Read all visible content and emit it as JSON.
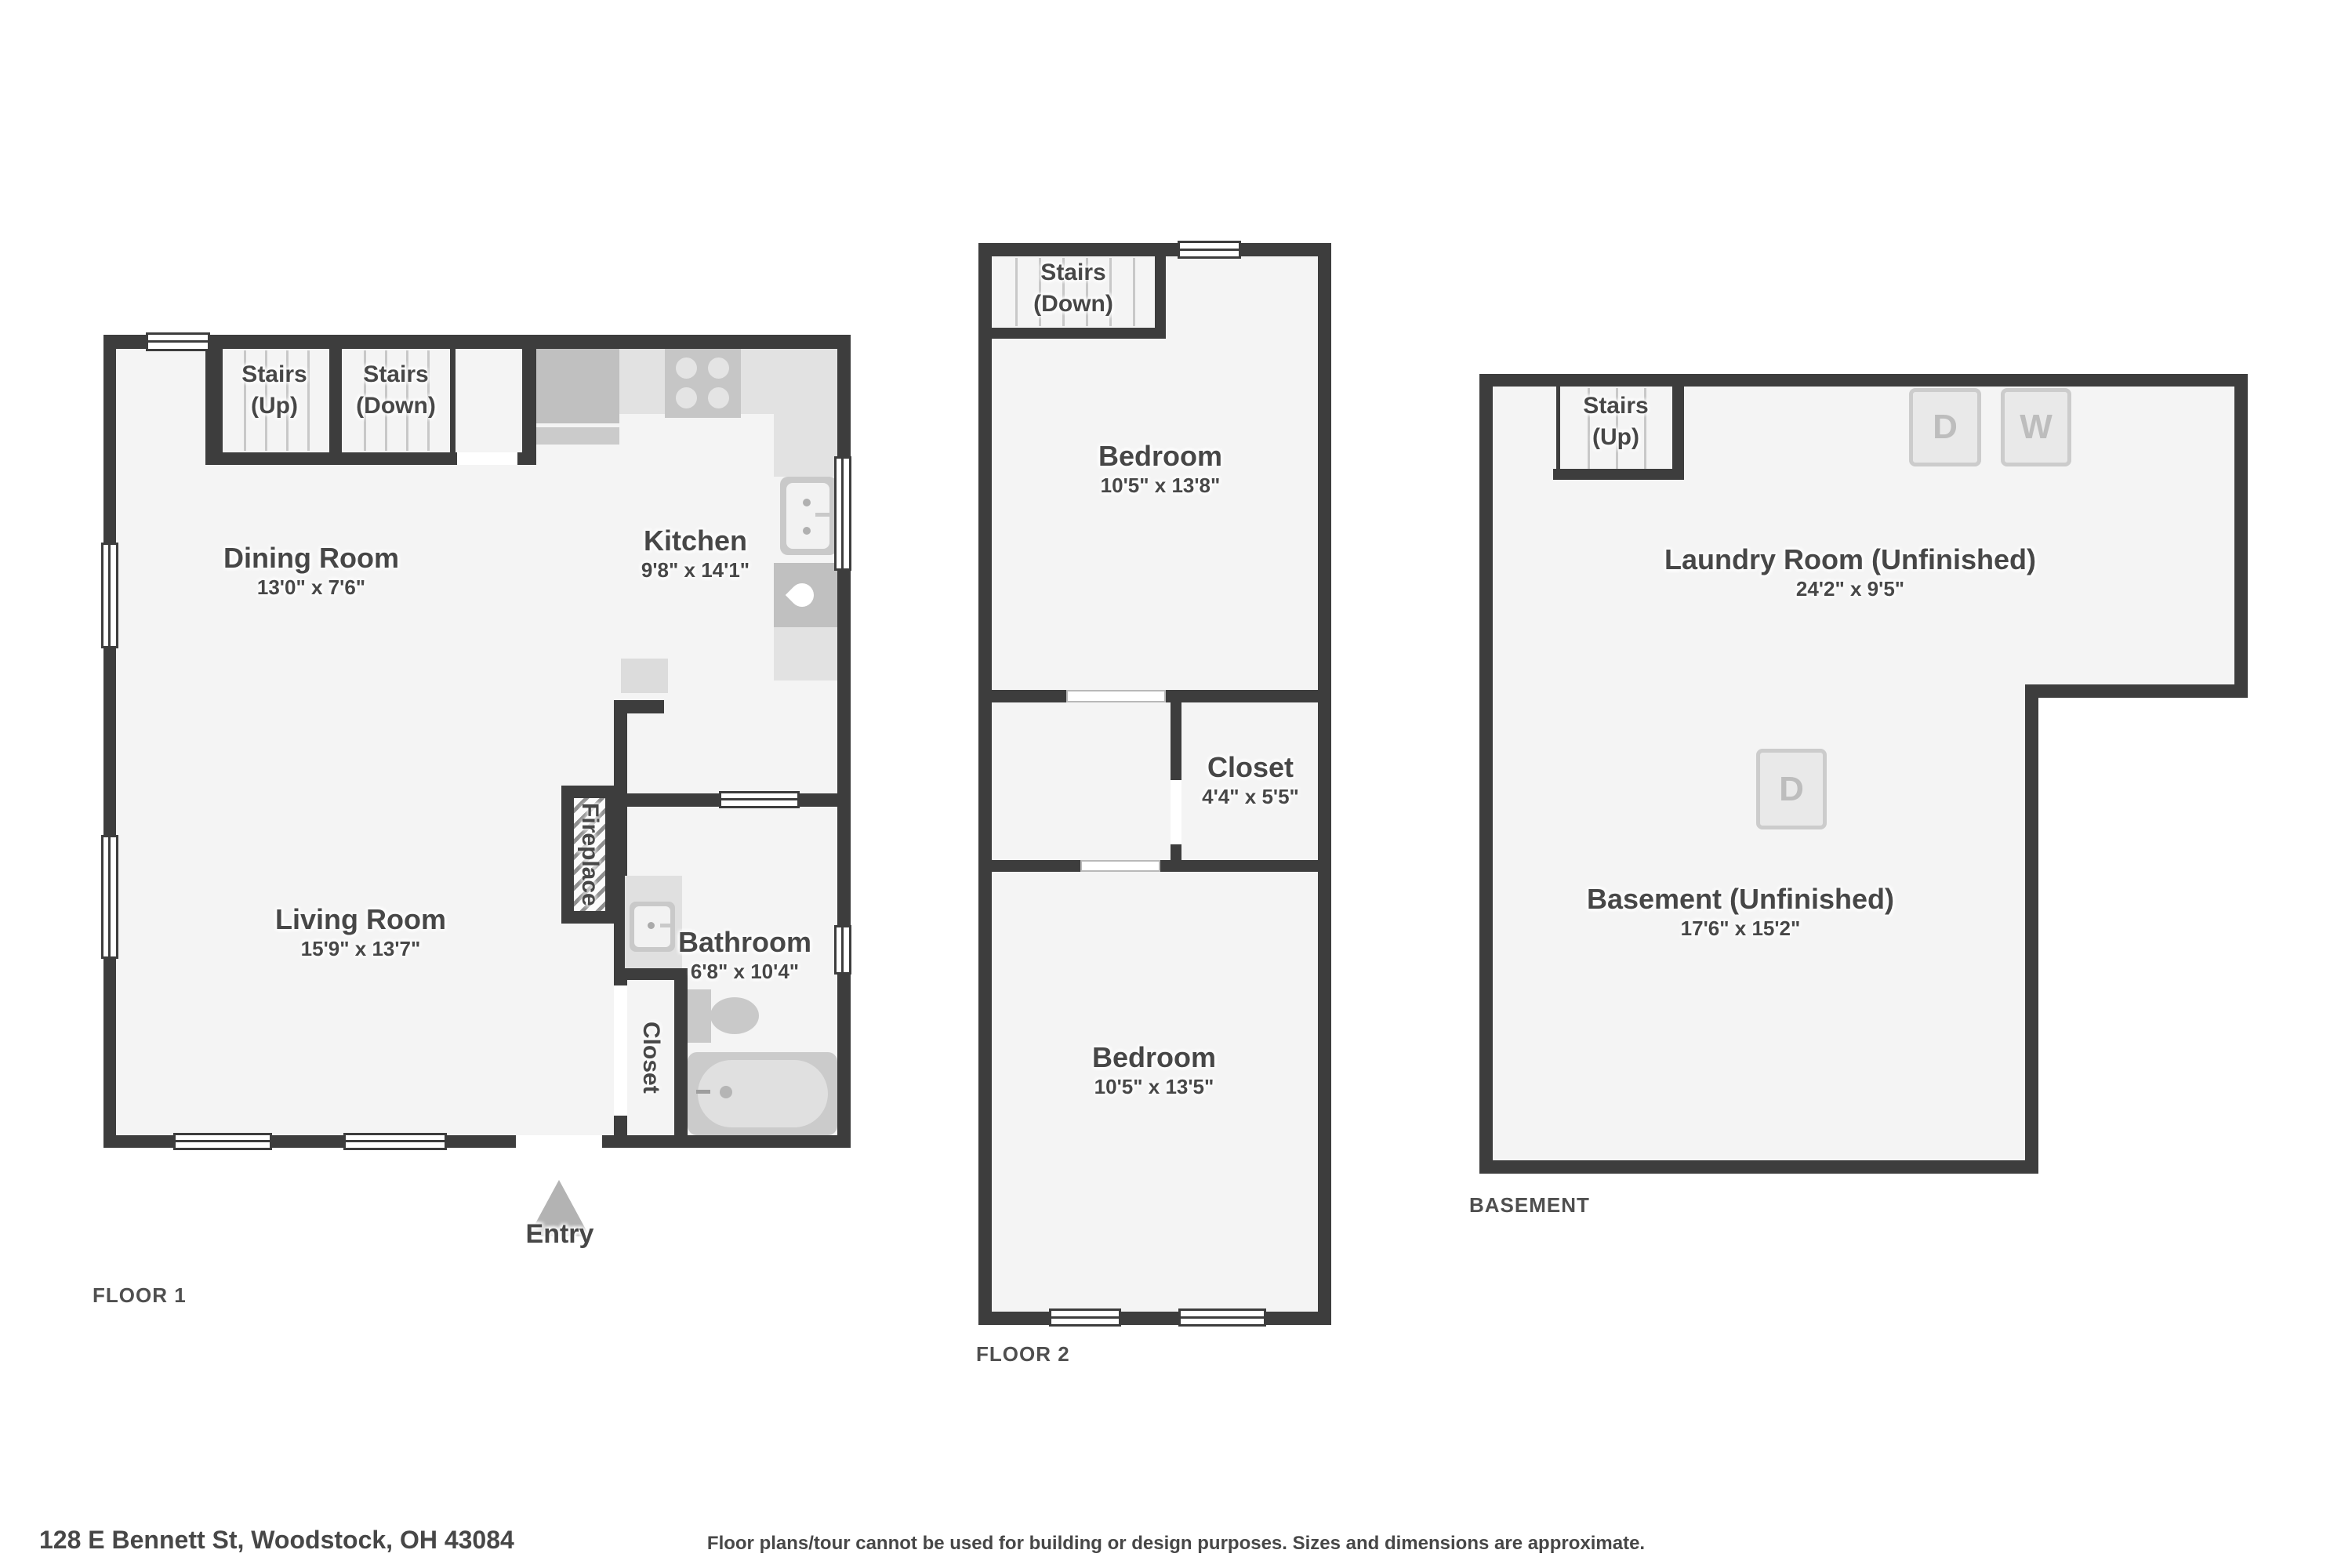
{
  "page": {
    "address": "128 E Bennett St, Woodstock, OH 43084",
    "disclaimer": "Floor plans/tour cannot be used for building or design purposes. Sizes and dimensions are approximate."
  },
  "floor1": {
    "tag": "FLOOR 1",
    "stairs_up": {
      "line1": "Stairs",
      "line2": "(Up)"
    },
    "stairs_down": {
      "line1": "Stairs",
      "line2": "(Down)"
    },
    "dining": {
      "name": "Dining Room",
      "dims": "13'0\" x 7'6\""
    },
    "kitchen": {
      "name": "Kitchen",
      "dims": "9'8\" x 14'1\""
    },
    "living": {
      "name": "Living Room",
      "dims": "15'9\" x 13'7\""
    },
    "bathroom": {
      "name": "Bathroom",
      "dims": "6'8\" x 10'4\""
    },
    "fireplace": "Fireplace",
    "closet": "Closet",
    "entry": "Entry"
  },
  "floor2": {
    "tag": "FLOOR 2",
    "stairs_down": {
      "line1": "Stairs",
      "line2": "(Down)"
    },
    "bedroom1": {
      "name": "Bedroom",
      "dims": "10'5\" x 13'8\""
    },
    "closet": {
      "name": "Closet",
      "dims": "4'4\" x 5'5\""
    },
    "bedroom2": {
      "name": "Bedroom",
      "dims": "10'5\" x 13'5\""
    }
  },
  "basement": {
    "tag": "BASEMENT",
    "stairs_up": {
      "line1": "Stairs",
      "line2": "(Up)"
    },
    "laundry": {
      "name": "Laundry Room (Unfinished)",
      "dims": "24'2\" x 9'5\""
    },
    "main": {
      "name": "Basement (Unfinished)",
      "dims": "17'6\" x 15'2\""
    },
    "dryer_top": "D",
    "washer_top": "W",
    "dryer_mid": "D"
  },
  "colors": {
    "wall": "#3d3d3d",
    "floor": "#f4f4f4",
    "label_text": "#474747",
    "tag_text": "#4f4f4f",
    "fixture_light": "#e2e2e2",
    "fixture_mid": "#c6c6c6",
    "stair_line": "#c8c8c8",
    "appliance_letter": "#bdbdbd",
    "entry_arrow": "#b3b3b3"
  }
}
